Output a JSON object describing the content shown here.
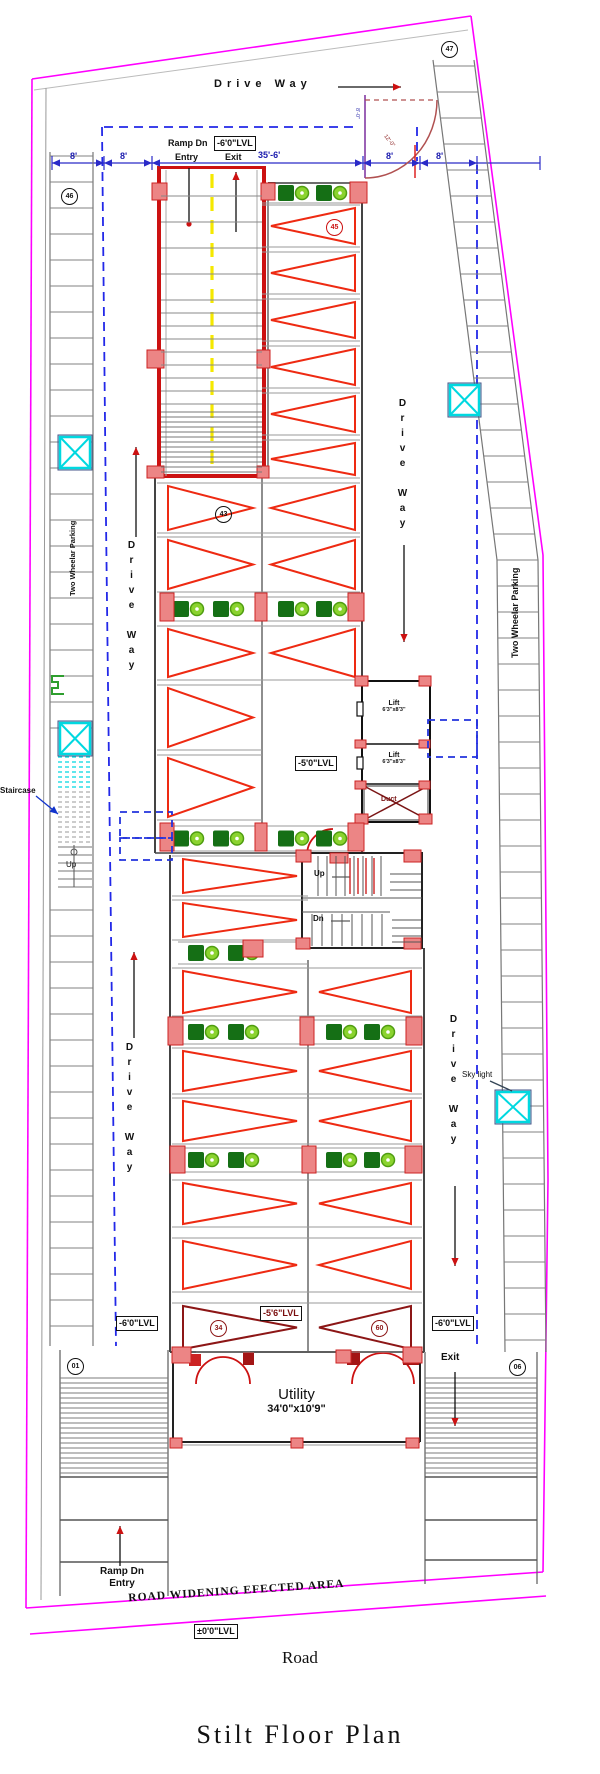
{
  "title": "Stilt  Floor  Plan",
  "road_label": "Road",
  "road_widening_label": "ROAD WIDENING EFECTED AREA",
  "levels": {
    "zero": "±0'0\"LVL",
    "minus6": "-6'0\"LVL",
    "minus5": "-5'0\"LVL",
    "minus56": "-5'6\"LVL"
  },
  "driveway": {
    "top": "Drive Way",
    "left_upper": "Drive Way",
    "left_lower": "Drive Way",
    "right_upper": "Drive Way",
    "right_lower": "Drive Way"
  },
  "ramp": {
    "label": "Ramp Dn",
    "entry": "Entry",
    "exit": "Exit"
  },
  "bottom": {
    "ramp_label": "Ramp Dn",
    "entry": "Entry",
    "exit": "Exit"
  },
  "utility": {
    "name": "Utility",
    "size": "34'0\"x10'9\""
  },
  "lift": {
    "name": "Lift",
    "size": "6'3\"x8'3\""
  },
  "duct": "Duct",
  "stair": {
    "up": "Up",
    "dn": "Dn",
    "left_up": "Up",
    "staircase": "Staircase"
  },
  "skylight": "Sky light",
  "two_wheeler": "Two Wheelar Parking",
  "dimensions": {
    "seg": [
      "8'",
      "8'",
      "35'-6'",
      "8'",
      "8'"
    ],
    "gate": [
      "8'-0\"",
      "12'-0\""
    ]
  },
  "stall_numbers": {
    "top_right": "47",
    "top_left": "46",
    "ramp_side": "45",
    "mid_left": "43",
    "bottom_left_tri": "34",
    "bottom_right_tri": "60",
    "corner_left": "01",
    "corner_right": "06"
  },
  "colors": {
    "boundary": "#ff00ff",
    "driveway_dash": "#2228e8",
    "dim_blue": "#2a2ac8",
    "stall_red": "#ee2a12",
    "stall_dark": "#8c1616",
    "column_fill": "#ec8585",
    "column_edge": "#cc2222",
    "bike_body": "#156f15",
    "bike_wheel": "#8bd32f",
    "cyan": "#00d8e0",
    "ramp_line_yellow": "#f5e800",
    "wall_gray": "#777777"
  },
  "plan": {
    "left_stalls": {
      "x1": 50,
      "x2": 93,
      "y0": 156,
      "y1": 1342,
      "step": 26,
      "skip": [
        748,
        892
      ]
    },
    "right_stalls": {
      "edge": [
        [
          433,
          60
        ],
        [
          497,
          560
        ],
        [
          505,
          1352
        ]
      ],
      "w": 41,
      "y0": 66,
      "y1": 1350,
      "step": 26
    },
    "bottom_blocks": [
      {
        "x1": 60,
        "x2": 168,
        "top": 1350,
        "h0": 1378,
        "h1": 1477,
        "hstep": 5,
        "lines": [
          1477,
          1520,
          1562
        ],
        "bot": 1596
      },
      {
        "x1": 425,
        "x2": 537,
        "top": 1352,
        "h0": 1378,
        "h1": 1477,
        "hstep": 5,
        "lines": [
          1477,
          1520,
          1560
        ],
        "bot": 1584
      }
    ],
    "sections": {
      "1": {
        "L": [
          165,
          256
        ],
        "R": [
          268,
          358
        ],
        "div": 262,
        "wallL": 155,
        "wallR": 362
      },
      "2": {
        "L": [
          180,
          300
        ],
        "R": [
          316,
          414
        ],
        "div": 308,
        "wallL": 170,
        "wallR": 424
      }
    },
    "triangle_rows": [
      {
        "y0": 205,
        "y1": 247,
        "sides": "R",
        "sec": "1"
      },
      {
        "y0": 252,
        "y1": 294,
        "sides": "R",
        "sec": "1"
      },
      {
        "y0": 299,
        "y1": 341,
        "sides": "R",
        "sec": "1"
      },
      {
        "y0": 346,
        "y1": 388,
        "sides": "R",
        "sec": "1"
      },
      {
        "y0": 393,
        "y1": 435,
        "sides": "R",
        "sec": "1"
      },
      {
        "y0": 440,
        "y1": 478,
        "sides": "R",
        "sec": "1"
      },
      {
        "y0": 483,
        "y1": 533,
        "sides": "LR",
        "sec": "1"
      },
      {
        "y0": 537,
        "y1": 592,
        "sides": "LR",
        "sec": "1"
      },
      {
        "y0": 626,
        "y1": 680,
        "sides": "LR",
        "sec": "1"
      },
      {
        "y0": 685,
        "y1": 750,
        "sides": "L",
        "sec": "1"
      },
      {
        "y0": 755,
        "y1": 820,
        "sides": "L",
        "sec": "1"
      },
      {
        "y0": 856,
        "y1": 896,
        "sides": "L",
        "sec": "2"
      },
      {
        "y0": 900,
        "y1": 940,
        "sides": "L",
        "sec": "2"
      },
      {
        "y0": 968,
        "y1": 1016,
        "sides": "LR",
        "sec": "2"
      },
      {
        "y0": 1048,
        "y1": 1094,
        "sides": "LR",
        "sec": "2"
      },
      {
        "y0": 1098,
        "y1": 1144,
        "sides": "LR",
        "sec": "2"
      },
      {
        "y0": 1180,
        "y1": 1227,
        "sides": "LR",
        "sec": "2"
      },
      {
        "y0": 1238,
        "y1": 1292,
        "sides": "LR",
        "sec": "2"
      },
      {
        "y0": 1303,
        "y1": 1352,
        "sides": "LR",
        "sec": "2",
        "dark": true
      }
    ],
    "green_rows": [
      {
        "y": 183,
        "h": 20,
        "halves": "R",
        "sec": "1"
      },
      {
        "y": 597,
        "h": 24,
        "halves": "LR",
        "sec": "1"
      },
      {
        "y": 826,
        "h": 25,
        "halves": "LR",
        "sec": "1"
      },
      {
        "y": 942,
        "h": 22,
        "halves": "L",
        "sec": "2"
      },
      {
        "y": 1020,
        "h": 24,
        "halves": "LR",
        "sec": "2"
      },
      {
        "y": 1148,
        "h": 24,
        "halves": "LR",
        "sec": "2"
      }
    ],
    "red_columns": [
      [
        152,
        183,
        15,
        17
      ],
      [
        261,
        183,
        14,
        17
      ],
      [
        350,
        182,
        17,
        21
      ],
      [
        147,
        350,
        17,
        18
      ],
      [
        257,
        350,
        13,
        18
      ],
      [
        147,
        466,
        17,
        12
      ],
      [
        257,
        466,
        12,
        12
      ],
      [
        160,
        593,
        14,
        28
      ],
      [
        255,
        593,
        12,
        28
      ],
      [
        348,
        593,
        16,
        28
      ],
      [
        355,
        676,
        13,
        10
      ],
      [
        419,
        676,
        12,
        10
      ],
      [
        355,
        740,
        11,
        8
      ],
      [
        419,
        740,
        11,
        8
      ],
      [
        355,
        781,
        11,
        8
      ],
      [
        419,
        781,
        11,
        8
      ],
      [
        355,
        814,
        13,
        10
      ],
      [
        419,
        814,
        13,
        10
      ],
      [
        160,
        823,
        14,
        28
      ],
      [
        255,
        823,
        12,
        28
      ],
      [
        348,
        823,
        16,
        28
      ],
      [
        296,
        850,
        15,
        12
      ],
      [
        404,
        850,
        17,
        12
      ],
      [
        330,
        853,
        18,
        10
      ],
      [
        296,
        938,
        14,
        11
      ],
      [
        404,
        938,
        17,
        11
      ],
      [
        243,
        940,
        20,
        17
      ],
      [
        168,
        1017,
        15,
        28
      ],
      [
        300,
        1017,
        14,
        28
      ],
      [
        406,
        1017,
        16,
        28
      ],
      [
        170,
        1146,
        15,
        27
      ],
      [
        302,
        1146,
        14,
        27
      ],
      [
        405,
        1146,
        17,
        27
      ],
      [
        172,
        1347,
        19,
        16
      ],
      [
        336,
        1350,
        15,
        13
      ],
      [
        403,
        1347,
        19,
        16
      ],
      [
        170,
        1438,
        12,
        10
      ],
      [
        291,
        1438,
        12,
        10
      ],
      [
        406,
        1438,
        13,
        10
      ]
    ],
    "cyan_boxes": [
      [
        60,
        437,
        30,
        31
      ],
      [
        60,
        723,
        30,
        31
      ],
      [
        450,
        385,
        29,
        30
      ],
      [
        497,
        1092,
        32,
        30
      ]
    ],
    "dashed_rects": [
      [
        120,
        812,
        52,
        26
      ],
      [
        120,
        838,
        52,
        22
      ],
      [
        428,
        720,
        49,
        37
      ]
    ],
    "arrows": [
      {
        "p": [
          338,
          87,
          401,
          87
        ],
        "h": "head"
      },
      {
        "p": [
          136,
          537,
          136,
          447
        ],
        "h": "head"
      },
      {
        "p": [
          134,
          1038,
          134,
          952
        ],
        "h": "head"
      },
      {
        "p": [
          404,
          545,
          404,
          642
        ],
        "h": "head"
      },
      {
        "p": [
          455,
          1186,
          455,
          1266
        ],
        "h": "head"
      },
      {
        "p": [
          189,
          168,
          189,
          224
        ],
        "h": "dot"
      },
      {
        "p": [
          236,
          232,
          236,
          172
        ],
        "h": "head"
      },
      {
        "p": [
          455,
          1372,
          455,
          1426
        ],
        "h": "head"
      },
      {
        "p": [
          120,
          1566,
          120,
          1526
        ],
        "h": "head"
      },
      {
        "p": [
          36,
          796,
          58,
          814
        ],
        "h": "head",
        "c": "#1133cc",
        "hc": "#1133cc"
      },
      {
        "p": [
          490,
          1081,
          512,
          1091
        ],
        "h": "none",
        "c": "#334455"
      }
    ],
    "dim_segments": [
      [
        52,
        104
      ],
      [
        104,
        152
      ],
      [
        152,
        363
      ],
      [
        363,
        420
      ],
      [
        420,
        477
      ]
    ],
    "dim_ticks": [
      52,
      104,
      152,
      363,
      420,
      477,
      540
    ]
  }
}
